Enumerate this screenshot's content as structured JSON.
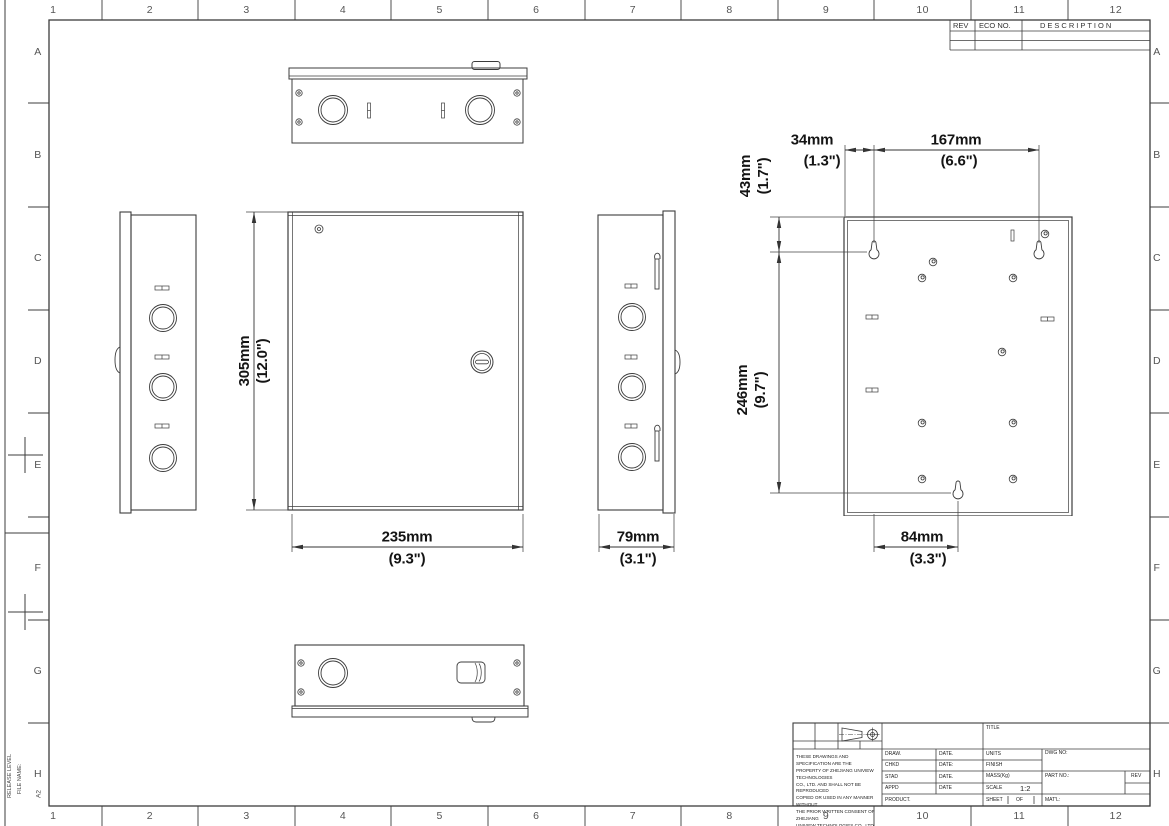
{
  "sheet": {
    "cols": [
      "1",
      "2",
      "3",
      "4",
      "5",
      "6",
      "7",
      "8",
      "9",
      "10",
      "11",
      "12"
    ],
    "rows": [
      "A",
      "B",
      "C",
      "D",
      "E",
      "F",
      "G",
      "H"
    ],
    "release_level_label": "RELEASE LEVEL",
    "file_name_label": "FILE NAME:",
    "size_code": "A2"
  },
  "rev_table": {
    "rev": "REV",
    "eco_no": "ECO NO.",
    "description": "DESCRIPTION"
  },
  "dims": {
    "front_h_mm": "305mm",
    "front_h_in": "(12.0\")",
    "front_w_mm": "235mm",
    "front_w_in": "(9.3\")",
    "depth_mm": "79mm",
    "depth_in": "(3.1\")",
    "off_x_mm": "34mm",
    "off_x_in": "(1.3\")",
    "span_x_mm": "167mm",
    "span_x_in": "(6.6\")",
    "off_y_mm": "43mm",
    "off_y_in": "(1.7\")",
    "span_y_mm": "246mm",
    "span_y_in": "(9.7\")",
    "bot_mm": "84mm",
    "bot_in": "(3.3\")"
  },
  "title_block": {
    "title": "TITLE",
    "draw": "DRAW.",
    "chkd": "CHKD",
    "stad": "STAD",
    "appd": "APPD",
    "date1": "DATE.",
    "date2": "DATE:",
    "date3": "DATE.",
    "date4": "DATE",
    "product": "PRODUCT.",
    "units": "UNITS",
    "finish": "FINISH",
    "mass": "MASS(Kg)",
    "scale": "SCALE",
    "scale_value": "1:2",
    "sheet": "SHEET",
    "of": "OF",
    "matl": "MAT'L:",
    "dwg_no": "DWG NO:",
    "part_no": "PART NO.:",
    "rev": "REV",
    "disclaimer": [
      "THESE DRAWINGS AND SPECIFICATION ARE THE",
      "PROPERTY OF ZHEJIANG UNIVIEW TECHNOLOGIES",
      "CO., LTD. AND SHALL NOT BE REPRODUCED",
      "COPIED OR USED IN ANY MANNER WITHOUT",
      "THE PRIOR WRITTEN CONSENT OF ZHEJIANG",
      "UNIVIEW TECHNOLOGIES CO., LTD."
    ]
  },
  "colors": {
    "line": "#3c3c3c",
    "dim_text": "#141414"
  }
}
